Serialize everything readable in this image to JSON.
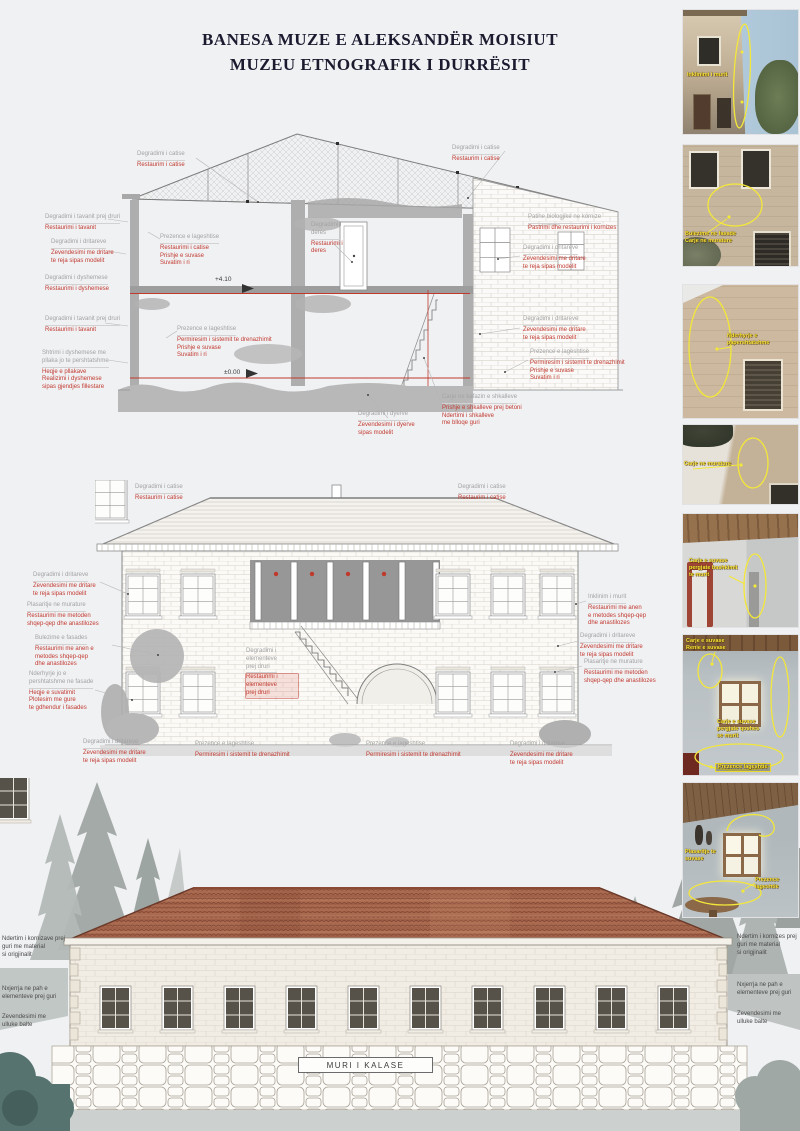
{
  "title": {
    "line1": "BANESA MUZE E ALEKSANDËR MOISIUT",
    "line2": "MUZEU ETNOGRAFIK I DURRËSIT"
  },
  "levels": {
    "upper": "+4.10",
    "ground": "±0.00"
  },
  "wall_label": "MURI I KALASE",
  "section": {
    "s1": {
      "g": "Degradimi i catise",
      "r": "Restaurim i catise"
    },
    "s2": {
      "g": "Degradimi i tavanit prej druri",
      "r": "Restaurimi i tavanit"
    },
    "s3": {
      "g": "Degradimi i dritareve",
      "r": "Zevendesimi me dritare\nte reja sipas modelit"
    },
    "s4": {
      "g": "Degradimi i dyshemese",
      "r": "Restaurimi i dyshemese"
    },
    "s5": {
      "g": "Degradimi i tavanit prej druri",
      "r": "Restaurimi i tavanit"
    },
    "s6": {
      "g": "Shtrimi i dyshemese me\npllaka jo te pershtatshme",
      "r": "Heqje e pllakave\nRealizimi i dyshemese\nsipas gjendjes fillestare"
    },
    "s7": {
      "g": "Prezence e lageshtise",
      "r": "Restaurimi i catise\nPrishje e suvase\nSuvatim i ri"
    },
    "s8": {
      "g": "Prezence e lageshtise",
      "r": "Permiresim i sistemit te drenazhimit\nPrishje e suvase\nSuvatim i ri"
    },
    "s9": {
      "g": "Degradimi i\nderes",
      "r": "Restaurimi i\nderes"
    },
    "s10": {
      "g": "Degradimi i catise",
      "r": "Restaurim i catise"
    },
    "s11": {
      "g": "Patine biologjike ne kornize",
      "r": "Pastrimi dhe restaurimi i kornizes"
    },
    "s12": {
      "g": "Degradimi i dritareve",
      "r": "Zevendesimi me dritare\nte reja sipas modelit"
    },
    "s13": {
      "g": "Degradimi i dritareve",
      "r": "Zevendesimi me dritare\nte reja sipas modelit"
    },
    "s14": {
      "g": "Prezence e lageshtise",
      "r": "Permiresim i sistemit te drenazhimit\nPrishje e suvase\nSuvatim i ri"
    },
    "s15": {
      "g": "Carje ne kafazin e shkalleve",
      "r": "Prishje e shkalleve prej betoni\nNdertimi i shkalleve\nme blloqe guri"
    },
    "s16": {
      "g": "Degradimi i dyerve",
      "r": "Zevendesimi i dyerve\nsipas modelit"
    }
  },
  "elevation": {
    "e1": {
      "g": "Degradimi i catise",
      "r": "Restaurim i catise"
    },
    "e2": {
      "g": "Degradimi i catise",
      "r": "Restaurim i catise"
    },
    "e3": {
      "g": "Degradimi i dritareve",
      "r": "Zevendesimi me dritare\nte reja sipas modelit"
    },
    "e4": {
      "g": "Plasaritje ne murature",
      "r": "Restaurimi me metoden\nshqep-qep dhe anastilozes"
    },
    "e5": {
      "g": "Bulezime e fasades",
      "r": "Restaurimi me anen e\nmetodes shqep-qep\ndhe anastilozes"
    },
    "e6": {
      "g": "Nderhyrje jo e\npershtatshme ne fasade",
      "r": "Heqje e suvatimit\nPlotesim me gure\nte gdhendur i fasades"
    },
    "e7": {
      "g": "Inklinim i murit",
      "r": "Restaurimi me anen\ne metodes shqep-qep\ndhe anastilozes"
    },
    "e8": {
      "g": "Degradimi i dritareve",
      "r": "Zevendesimi me dritare\nte reja sipas modelit"
    },
    "e9": {
      "g": "Plasaritje ne murature",
      "r": "Restaurimi me metoden\nshqep-qep dhe anastilozes"
    },
    "e10": {
      "g": "Degradimi i\nelementeve\nprej druri",
      "r": "Restaurimi i\nelementeve\nprej druri"
    },
    "e11": {
      "g": "Degradimi i dritareve",
      "r": "Zevendesimi me dritare\nte reja sipas modelit"
    },
    "e12": {
      "g": "Prezence e lageshtise",
      "r": "Permiresim i sistemit te drenazhimit"
    },
    "e13": {
      "g": "Prezence e lageshtise",
      "r": "Permiresim i sistemit te drenazhimit"
    },
    "e14": {
      "g": "Degradimi i dritareve",
      "r": "Zevendesimi me dritare\nte reja sipas modelit"
    }
  },
  "bottom": {
    "left1": "Ndertim i kornizave prej\nguri me material\nsi origjinalit",
    "left2": "Nxjerrja ne pah e\nelementeve prej guri",
    "left3": "Zevendesimi me\nulluke balte",
    "right1": "Ndertim i kornizes prej\nguri me material\nsi origjinalit",
    "right2": "Nxjerrja ne pah e\nelementeve prej guri",
    "right3": "Zevendesimi me\nulluke balte"
  },
  "photos": {
    "p1": {
      "label1": "Inklinimi i murit"
    },
    "p2": {
      "label1": "Bulezime ne fasade\nCarje ne murature"
    },
    "p3": {
      "label1": "Nderhyrje e\npapershtatshme"
    },
    "p4": {
      "label1": "Carje ne murature"
    },
    "p5": {
      "label1": "Carje e suvase\npergjate bashkimit\nte murit"
    },
    "p6": {
      "label1": "Carje e suvase\nRenie e suvase",
      "label2": "Carje e suvase\npergjate qoshes\nse murit",
      "label3": "Prezence lageshtie"
    },
    "p7": {
      "label1": "Plasaritje te\nsuvase",
      "label2": "Prezence\nlageshtie"
    }
  }
}
